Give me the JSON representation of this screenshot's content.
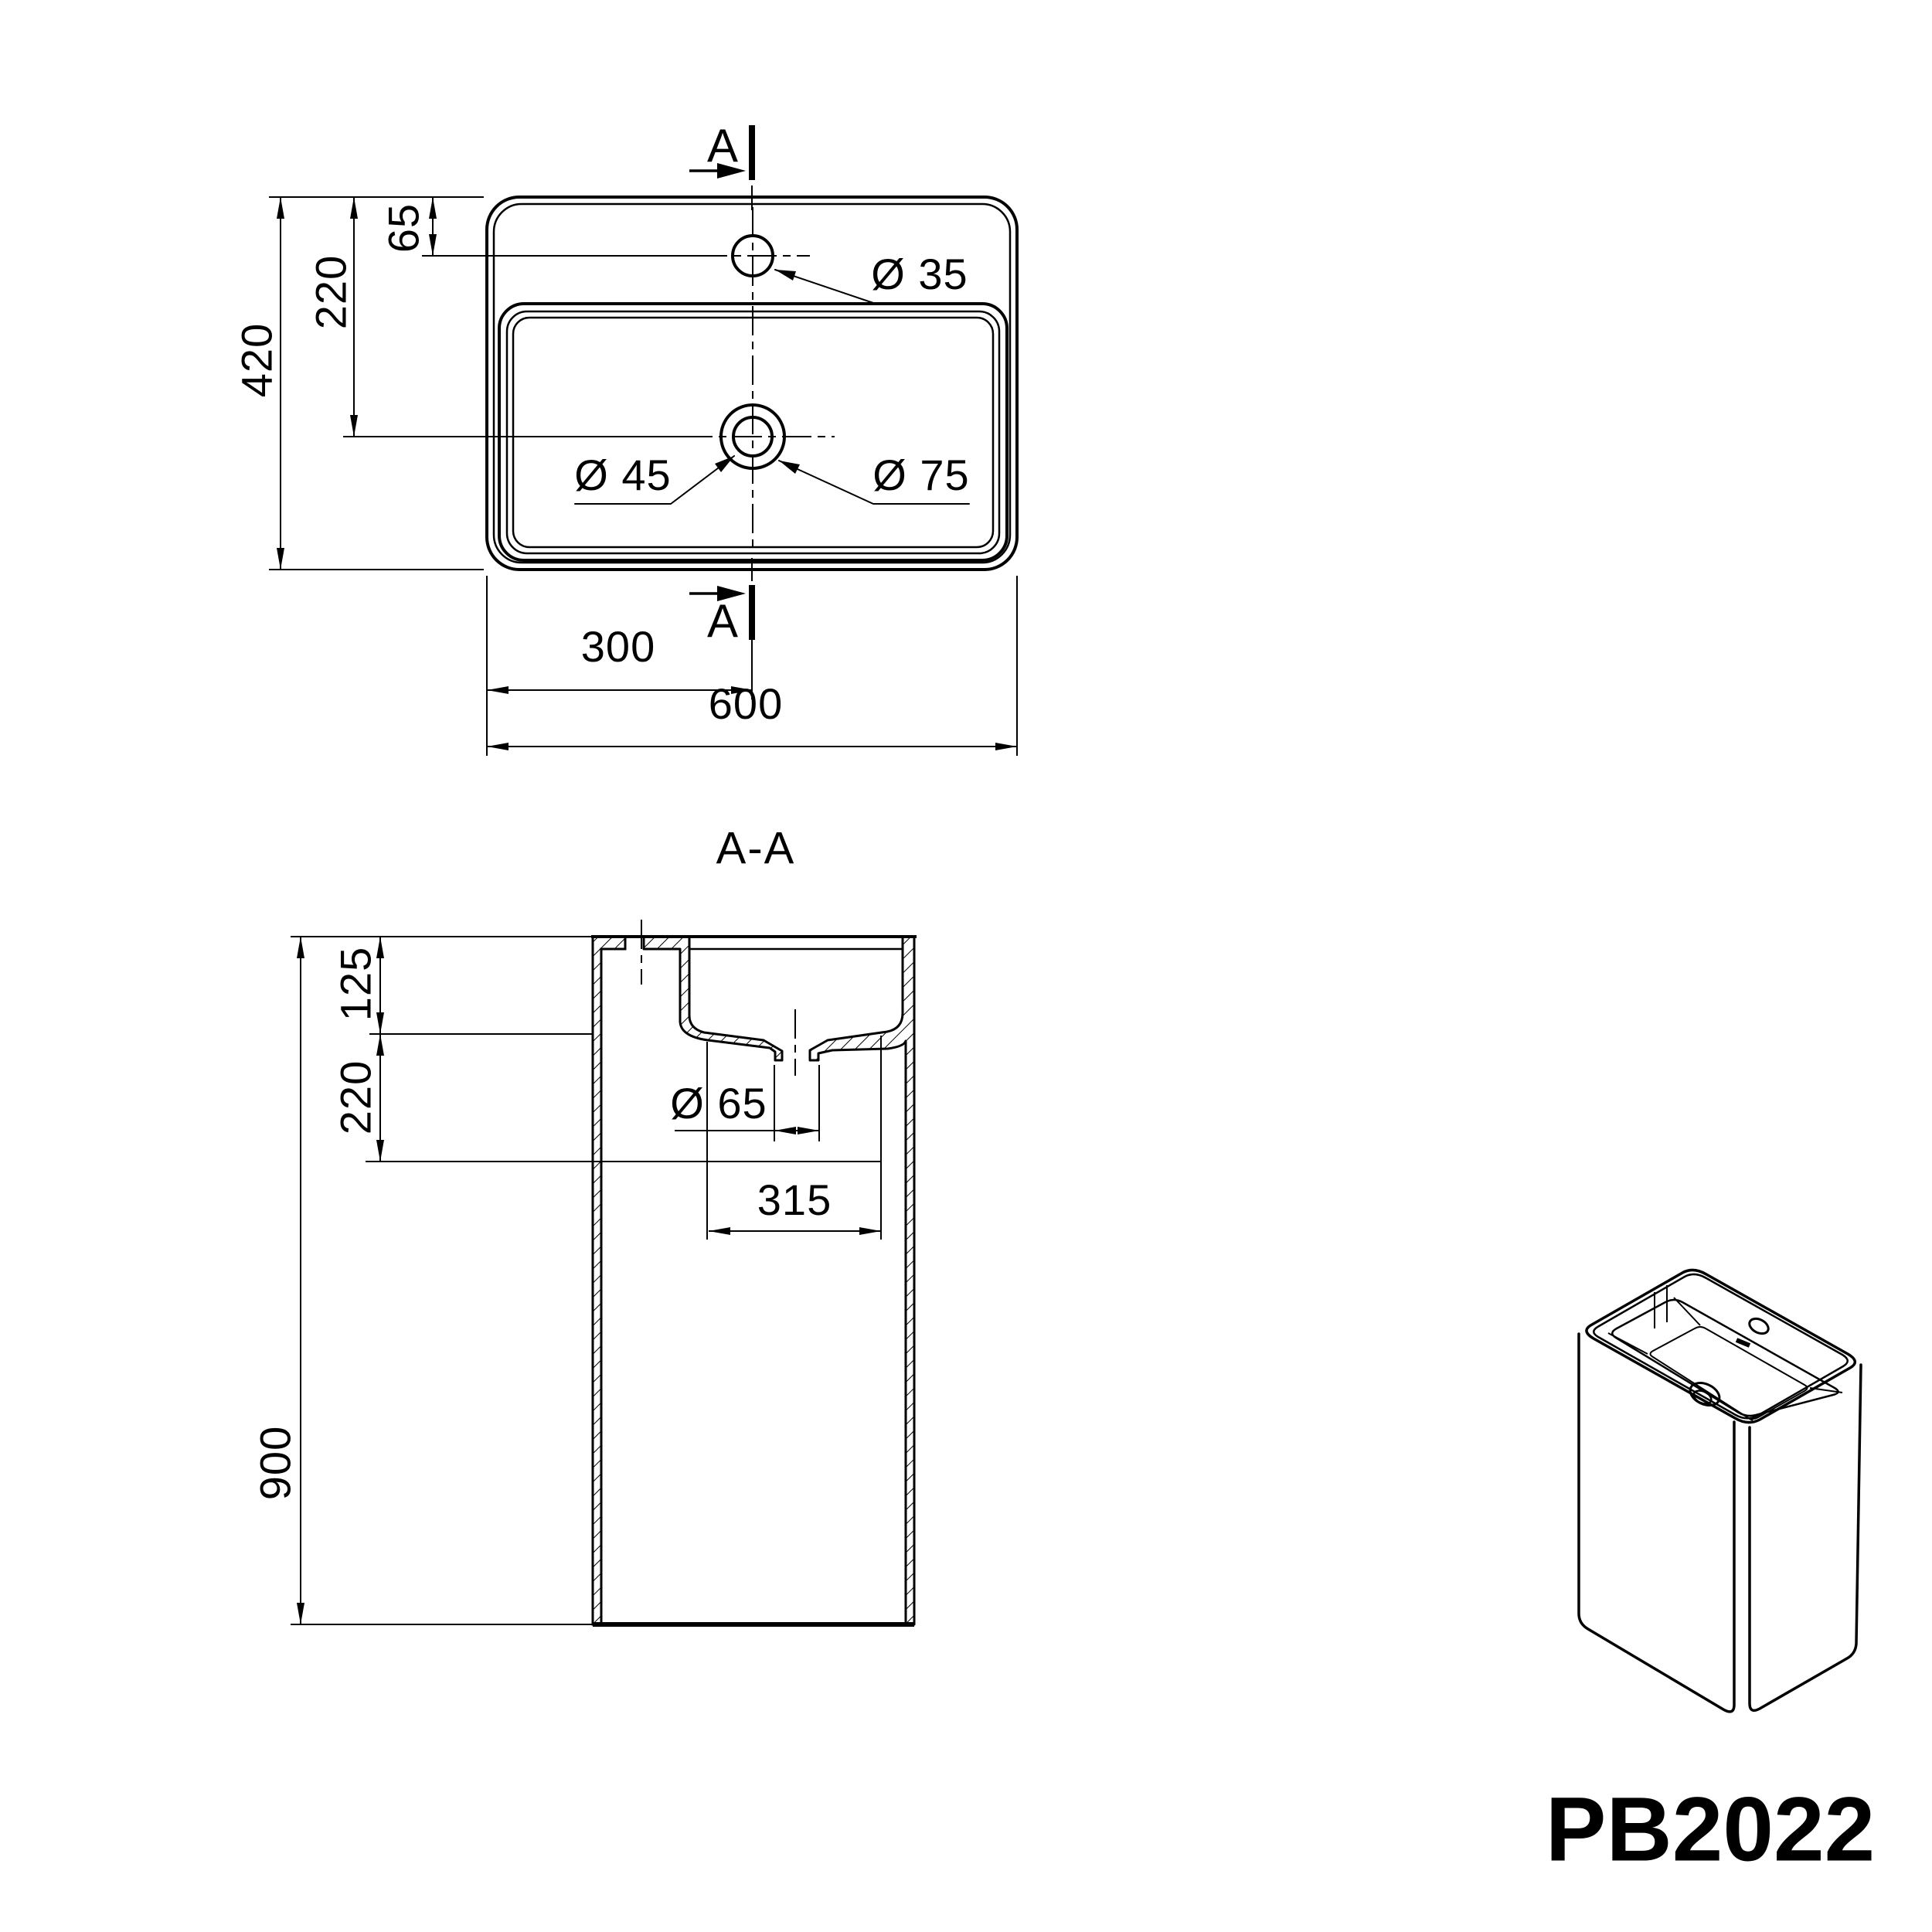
{
  "product_code": "PB2022",
  "colors": {
    "line": "#000000",
    "background": "#ffffff"
  },
  "plan": {
    "cut_letter": "A",
    "dim_depth": "420",
    "dim_drain_from_top": "220",
    "dim_faucet_from_top": "65",
    "dim_half_width": "300",
    "dim_width": "600",
    "dia_faucet": "Ø 35",
    "dia_drain_inner": "Ø 45",
    "dia_drain_outer": "Ø 75"
  },
  "section": {
    "title": "A-A",
    "dim_basin_depth": "125",
    "dim_drain_zone": "220",
    "dim_height": "900",
    "dia_outlet": "Ø 65",
    "dim_recess_width": "315"
  }
}
